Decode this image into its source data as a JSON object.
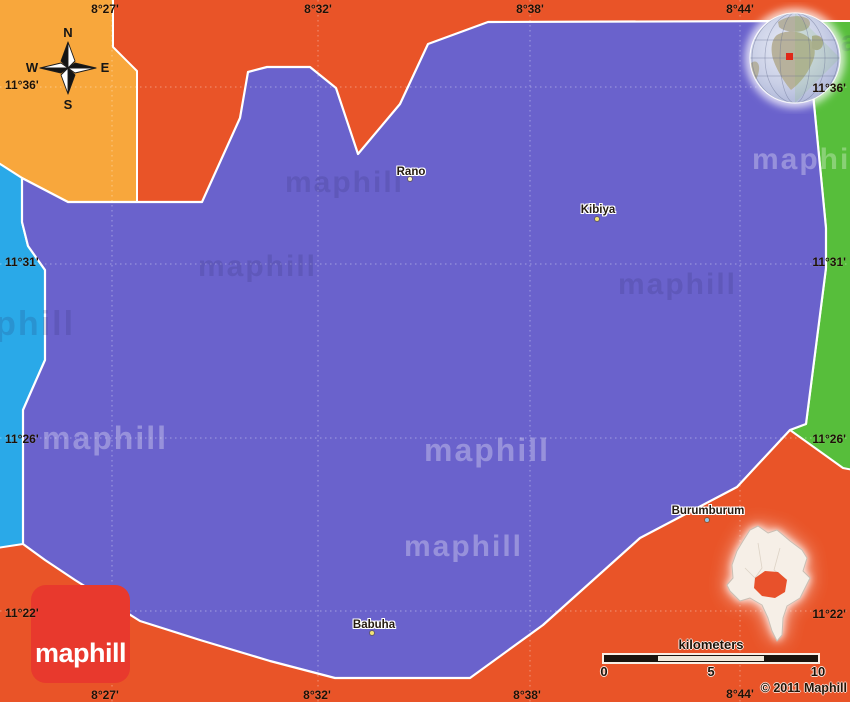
{
  "map": {
    "watermark_text": "maphill",
    "logo_text": "maphill",
    "copyright": "© 2011 Maphill",
    "scale": {
      "label": "kilometers",
      "ticks": [
        "0",
        "5",
        "10"
      ]
    },
    "compass": {
      "n": "N",
      "e": "E",
      "s": "S",
      "w": "W"
    },
    "places": [
      {
        "name": "Rano",
        "x": 411,
        "y": 172,
        "dot_x": 410,
        "dot_y": 179,
        "dot_color": "#fdf3c0"
      },
      {
        "name": "Kibiya",
        "x": 598,
        "y": 210,
        "dot_x": 597,
        "dot_y": 219,
        "dot_color": "#f2e374"
      },
      {
        "name": "Babuha",
        "x": 374,
        "y": 625,
        "dot_x": 372,
        "dot_y": 633,
        "dot_color": "#f2e374"
      },
      {
        "name": "Burumburum",
        "x": 708,
        "y": 511,
        "dot_x": 707,
        "dot_y": 520,
        "dot_color": "#8fc4e8"
      }
    ],
    "coordinates": {
      "top": [
        "8°27'",
        "8°32'",
        "8°38'",
        "8°44'"
      ],
      "bottom": [
        "8°27'",
        "8°32'",
        "8°38'",
        "8°44'"
      ],
      "left": [
        "11°36'",
        "11°31'",
        "11°26'",
        "11°22'"
      ],
      "right": [
        "11°36'",
        "11°31'",
        "11°26'",
        "11°22'"
      ]
    },
    "colors": {
      "main_region_purple": "#6A62CC",
      "background_red_orange": "#E95428",
      "top_left_orange": "#F8A73C",
      "left_strip_blue": "#2AA9E8",
      "right_strip_green": "#57BE3B",
      "logo_red": "#E8392D",
      "boundary_white": "#FFFFFF",
      "inset_shape_cream": "#F6EFE7",
      "inset_highlight": "#E8512B"
    }
  }
}
